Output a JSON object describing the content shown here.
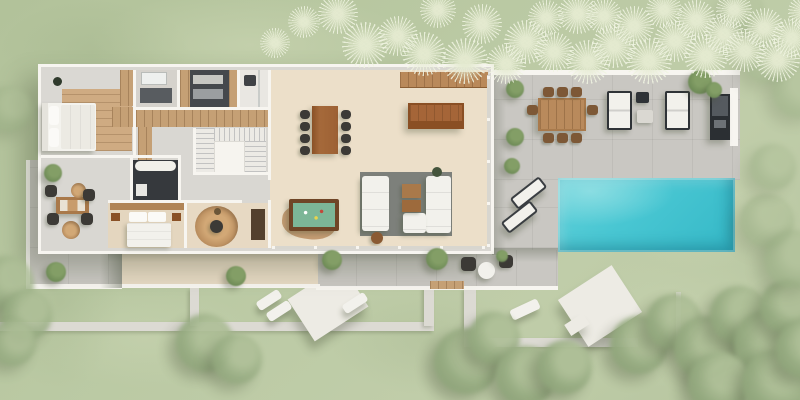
{
  "scene": {
    "name": "villa-aerial-3d-floor-plan-render",
    "description": "Top-down 3D rendering of a modern single-storey villa with garden, terraces and swimming pool",
    "width": 800,
    "height": 400
  },
  "palette": {
    "lawn": "#b6c59f",
    "lawn-light": "#c6d1b0",
    "lawn-dark": "#a6b98e",
    "path": "#dcdad3",
    "deck": "#c9c7c2",
    "terrace": "#e6d9c3",
    "wall": "#f7f5f0",
    "floor-cream": "#ecdfc9",
    "floor-gray": "#d9d7d2",
    "wood": "#a9794a",
    "wood-dark": "#8a5126",
    "wood-light": "#c5a075",
    "charcoal": "#3c3a36",
    "outdoor-dark": "#32363a",
    "white": "#f2f1ec",
    "rug-gray": "#7d807b",
    "jute": "#c49a6c",
    "pool": "#48c6d2",
    "pool-light": "#8adde2",
    "pool-dark": "#2aa9bc",
    "felt": "#7cb697",
    "tree": "#96ab81",
    "tree-dark": "#81976d",
    "shadow": "rgba(70,80,55,0.33)"
  },
  "rooms": [
    {
      "name": "master-bedroom"
    },
    {
      "name": "master-bathroom"
    },
    {
      "name": "dressing-room"
    },
    {
      "name": "guest-bathroom"
    },
    {
      "name": "staircase"
    },
    {
      "name": "second-bathroom"
    },
    {
      "name": "second-bedroom"
    },
    {
      "name": "study"
    },
    {
      "name": "open-plan-living-dining-kitchen"
    }
  ],
  "outdoor_areas": [
    {
      "name": "swimming-pool"
    },
    {
      "name": "pool-terrace"
    },
    {
      "name": "outdoor-dining-terrace"
    },
    {
      "name": "west-patio"
    },
    {
      "name": "south-terrace"
    },
    {
      "name": "sun-deck-platforms"
    },
    {
      "name": "lawn-garden"
    },
    {
      "name": "garden-paths"
    }
  ],
  "decor": {
    "patches": [
      [
        90,
        -10,
        320,
        110,
        0.55,
        "l"
      ],
      [
        470,
        90,
        210,
        95,
        0.5,
        "l"
      ],
      [
        600,
        140,
        200,
        130,
        0.6,
        "l"
      ],
      [
        560,
        250,
        240,
        140,
        0.45,
        "l"
      ],
      [
        30,
        288,
        230,
        100,
        0.4,
        "l"
      ],
      [
        0,
        0,
        190,
        100,
        0.3,
        "d"
      ],
      [
        0,
        210,
        120,
        180,
        0.3,
        "d"
      ],
      [
        330,
        285,
        200,
        110,
        0.3,
        "d"
      ]
    ],
    "tufts": [
      [
        318,
        -6,
        40
      ],
      [
        342,
        22,
        46
      ],
      [
        378,
        16,
        40
      ],
      [
        402,
        32,
        44
      ],
      [
        420,
        -8,
        36
      ],
      [
        442,
        38,
        46
      ],
      [
        462,
        4,
        40
      ],
      [
        486,
        44,
        40
      ],
      [
        504,
        20,
        44
      ],
      [
        528,
        0,
        36
      ],
      [
        534,
        32,
        40
      ],
      [
        558,
        -6,
        40
      ],
      [
        566,
        40,
        44
      ],
      [
        586,
        -2,
        36
      ],
      [
        592,
        24,
        44
      ],
      [
        614,
        6,
        40
      ],
      [
        626,
        38,
        46
      ],
      [
        646,
        -8,
        36
      ],
      [
        654,
        20,
        42
      ],
      [
        676,
        0,
        40
      ],
      [
        684,
        34,
        44
      ],
      [
        704,
        14,
        40
      ],
      [
        716,
        -8,
        36
      ],
      [
        724,
        30,
        42
      ],
      [
        744,
        8,
        40
      ],
      [
        756,
        38,
        44
      ],
      [
        772,
        18,
        40
      ],
      [
        788,
        -6,
        36
      ],
      [
        288,
        6,
        32
      ],
      [
        260,
        28,
        30
      ]
    ],
    "trees": [
      [
        -14,
        86,
        46,
        0.5
      ],
      [
        -20,
        256,
        54,
        0.8
      ],
      [
        2,
        290,
        50,
        0.85
      ],
      [
        -10,
        320,
        46,
        0.8
      ],
      [
        176,
        314,
        58,
        0.9
      ],
      [
        212,
        334,
        50,
        0.85
      ],
      [
        434,
        328,
        66,
        0.95
      ],
      [
        468,
        312,
        52,
        0.9
      ],
      [
        496,
        346,
        60,
        0.95
      ],
      [
        538,
        340,
        54,
        0.95
      ],
      [
        610,
        316,
        58,
        0.95
      ],
      [
        646,
        294,
        56,
        0.9
      ],
      [
        674,
        316,
        64,
        0.95
      ],
      [
        710,
        286,
        58,
        0.9
      ],
      [
        734,
        310,
        66,
        0.95
      ],
      [
        760,
        280,
        54,
        0.9
      ],
      [
        688,
        352,
        62,
        0.95
      ],
      [
        742,
        350,
        66,
        0.95
      ],
      [
        776,
        320,
        58,
        0.95
      ],
      [
        740,
        194,
        54,
        0.5
      ],
      [
        764,
        230,
        58,
        0.55
      ],
      [
        750,
        144,
        46,
        0.45
      ],
      [
        742,
        34,
        50,
        0.4
      ],
      [
        772,
        64,
        54,
        0.45
      ],
      [
        722,
        -10,
        42,
        0.35
      ]
    ],
    "bushes": [
      [
        44,
        164,
        18
      ],
      [
        46,
        262,
        20
      ],
      [
        226,
        266,
        20
      ],
      [
        322,
        250,
        20
      ],
      [
        426,
        248,
        22
      ],
      [
        506,
        80,
        18
      ],
      [
        506,
        128,
        18
      ],
      [
        504,
        158,
        16
      ],
      [
        688,
        70,
        24
      ],
      [
        706,
        82,
        16
      ],
      [
        496,
        250,
        12
      ]
    ],
    "dining_chairs": [
      [
        300,
        110
      ],
      [
        300,
        122
      ],
      [
        300,
        134
      ],
      [
        300,
        146
      ],
      [
        341,
        110
      ],
      [
        341,
        122
      ],
      [
        341,
        134
      ],
      [
        341,
        146
      ]
    ],
    "outdoor_chairs": [
      [
        543,
        87
      ],
      [
        557,
        87
      ],
      [
        571,
        87
      ],
      [
        543,
        133
      ],
      [
        557,
        133
      ],
      [
        571,
        133
      ],
      [
        527,
        105
      ],
      [
        587,
        105
      ]
    ],
    "patio_chairs": [
      [
        45,
        185
      ],
      [
        83,
        189
      ],
      [
        47,
        213
      ],
      [
        81,
        213
      ]
    ],
    "white_loungers": [
      [
        116,
        255,
        26,
        11,
        -33
      ],
      [
        152,
        253,
        26,
        11,
        -33
      ],
      [
        256,
        295,
        26,
        10,
        -33
      ],
      [
        266,
        306,
        26,
        10,
        -33
      ],
      [
        342,
        298,
        26,
        10,
        -33
      ],
      [
        510,
        304,
        30,
        11,
        -25
      ]
    ]
  }
}
